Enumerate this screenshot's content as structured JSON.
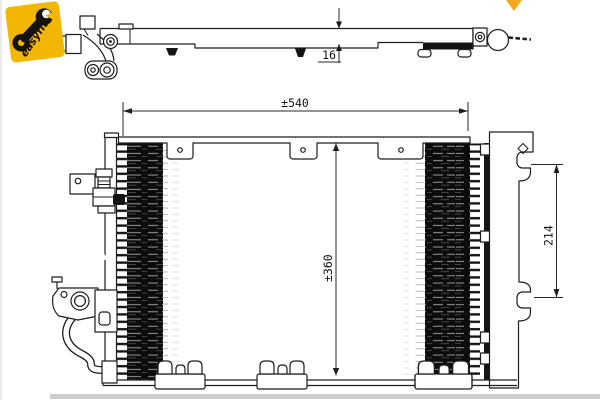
{
  "logo": {
    "text": "easyfit"
  },
  "dimensions": {
    "width_label": "±540",
    "height_label": "±360",
    "mount_label": "214",
    "depth_label": "16"
  },
  "colors": {
    "logo_yellow": "#f2b705",
    "accent": "#f0a81c",
    "line_black": "#1d1d1d"
  }
}
